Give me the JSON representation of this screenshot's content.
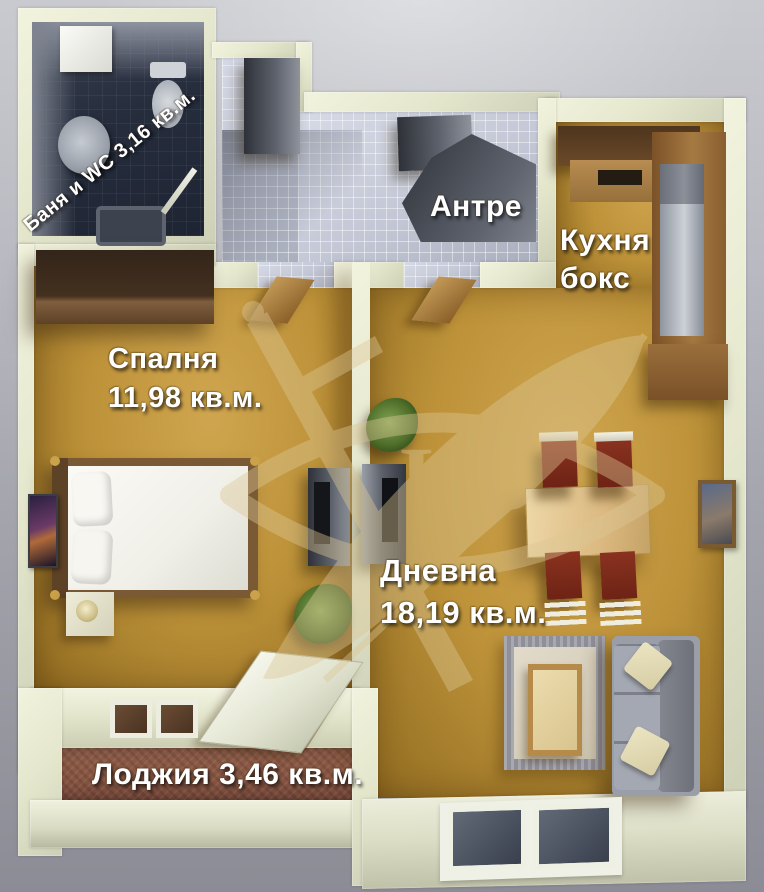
{
  "rooms": {
    "bathroom": {
      "label": "Баня и WC 3,16 кв.м."
    },
    "hall": {
      "name": "Антре"
    },
    "kitchen": {
      "line1": "Кухня",
      "line2": "бокс"
    },
    "bedroom": {
      "name": "Спалня",
      "area": "11,98 кв.м."
    },
    "living": {
      "name": "Дневна",
      "area": "18,19 кв.м."
    },
    "loggia": {
      "label": "Лоджия 3,46 кв.м."
    }
  },
  "watermark": {
    "initials": "НВ"
  },
  "colors": {
    "floor_ochre": "#bd9239",
    "wall_cream": "#e8e9d2",
    "bath_tile": "#242b3b",
    "hall_tile": "#c8ccd8",
    "loggia_brick": "#8a5644",
    "chair_red": "#7c2817",
    "background_gray": "#a8a9b1",
    "label_text": "#ffffff"
  }
}
